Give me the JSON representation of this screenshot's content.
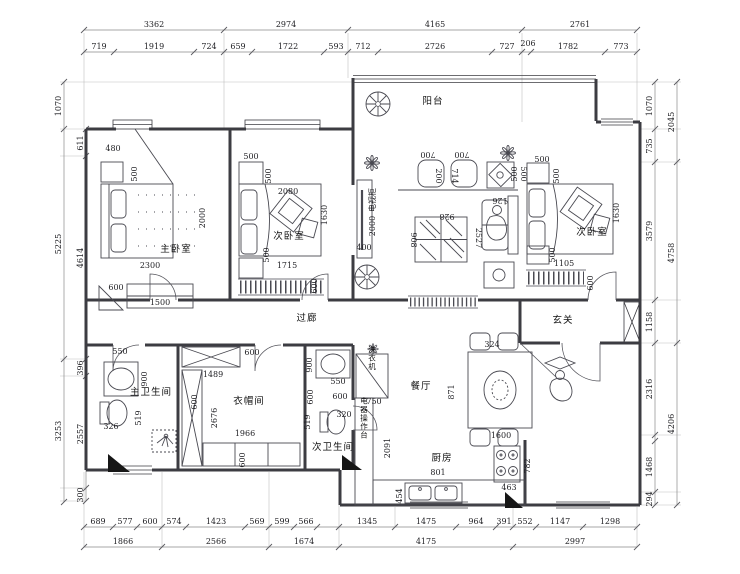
{
  "colors": {
    "bg": "#ffffff",
    "wall": "#3c3c42",
    "thin": "#4a4a52",
    "dim": "#8a8a8a",
    "text": "#1f1f23"
  },
  "rooms": {
    "balcony": "阳台",
    "master": "主卧室",
    "bed2": "次卧室",
    "bed3": "次卧室",
    "corridor": "过廊",
    "foyer": "玄关",
    "master_bath": "主卫生间",
    "cloakroom": "衣帽间",
    "bath2": "次卫生间",
    "dining": "餐厅",
    "kitchen": "厨房",
    "appliance_counter": "电器操作台",
    "washer": "洗衣机",
    "tv_cabinet": "电视柜"
  },
  "dims": {
    "t_o": [
      "3362",
      "2974",
      "4165",
      "2761"
    ],
    "t_i": [
      "719",
      "1919",
      "724",
      "659",
      "1722",
      "593",
      "712",
      "2726",
      "727",
      "206",
      "1782",
      "773"
    ],
    "l_o": [
      "1070",
      "5225",
      "3253"
    ],
    "l_i": [
      "611",
      "4614",
      "396",
      "2557",
      "300"
    ],
    "r_i": [
      "1070",
      "735",
      "3579",
      "1158",
      "2316",
      "1468",
      "294"
    ],
    "r_o": [
      "2045",
      "4758",
      "4206"
    ],
    "b_i": [
      "689",
      "577",
      "600",
      "574",
      "1423",
      "569",
      "599",
      "566",
      "1345",
      "1475",
      "964",
      "391",
      "552",
      "1147",
      "1298"
    ],
    "b_o": [
      "1866",
      "2566",
      "1674",
      "4175",
      "2997"
    ],
    "master": [
      "480",
      "500",
      "2000",
      "2300",
      "600",
      "1500"
    ],
    "bed2": [
      "500",
      "500",
      "2080",
      "1630",
      "500",
      "1715",
      "600"
    ],
    "bed3": [
      "500",
      "500",
      "500",
      "1630",
      "500",
      "1105",
      "600"
    ],
    "living": [
      "700",
      "700",
      "200",
      "714",
      "126",
      "500",
      "928",
      "908",
      "2527",
      "400",
      "2000"
    ],
    "master_bath": [
      "550",
      "900",
      "519",
      "326"
    ],
    "cloakroom": [
      "600",
      "1489",
      "600",
      "2676",
      "1966",
      "600"
    ],
    "bath2": [
      "900",
      "550",
      "600",
      "600",
      "519",
      "320",
      "750"
    ],
    "dining": [
      "324",
      "871",
      "1600"
    ],
    "kitchen": [
      "2091",
      "801",
      "454",
      "782",
      "463"
    ]
  }
}
